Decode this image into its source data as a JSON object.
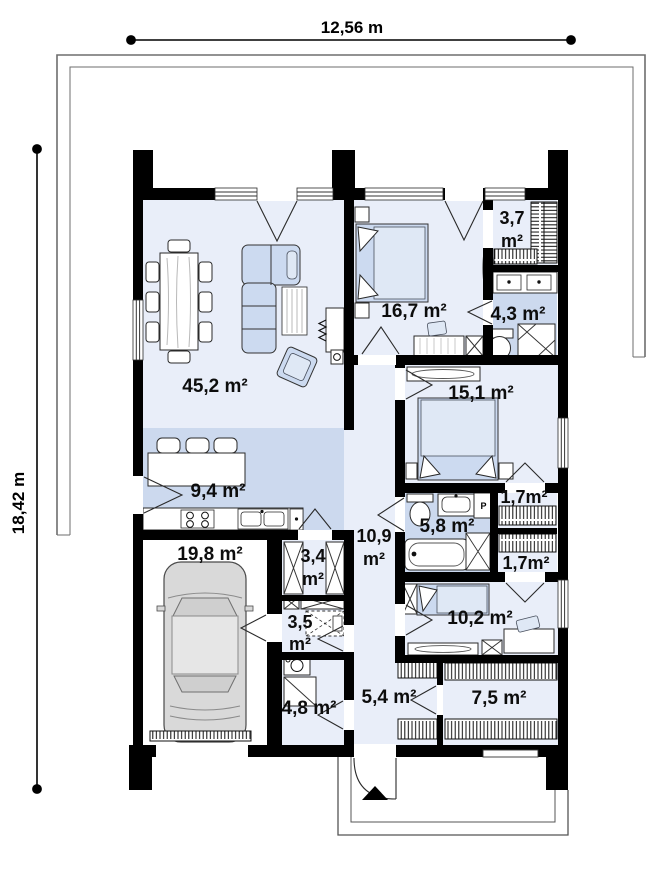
{
  "plan": {
    "dimension_width": "12,56 m",
    "dimension_height": "18,42 m",
    "rooms": [
      {
        "name": "living-dining-room",
        "area": "45,2 m²"
      },
      {
        "name": "kitchen",
        "area": "9,4 m²"
      },
      {
        "name": "bedroom-master",
        "area": "16,7 m²"
      },
      {
        "name": "wardrobe-master",
        "area_value": "3,7",
        "area_unit": "m²"
      },
      {
        "name": "bathroom-ensuite",
        "area": "4,3 m²"
      },
      {
        "name": "bedroom-2",
        "area": "15,1 m²"
      },
      {
        "name": "wardrobe-a",
        "area": "1,7m²"
      },
      {
        "name": "bathroom-main",
        "area": "5,8 m²"
      },
      {
        "name": "hallway",
        "area_value": "10,9",
        "area_unit": "m²"
      },
      {
        "name": "wardrobe-b",
        "area": "1,7m²"
      },
      {
        "name": "pantry",
        "area_value": "3,4",
        "area_unit": "m²"
      },
      {
        "name": "garage",
        "area": "19,8 m²"
      },
      {
        "name": "utility",
        "area_value": "3,5",
        "area_unit": "m²"
      },
      {
        "name": "bedroom-3",
        "area": "10,2 m²"
      },
      {
        "name": "boiler-room",
        "area": "4,8 m²"
      },
      {
        "name": "corridor",
        "area": "5,4 m²"
      },
      {
        "name": "wardrobe-hall",
        "area": "7,5 m²"
      }
    ],
    "appliance_labels": {
      "washer": "P"
    },
    "colors": {
      "wall": "#000000",
      "room_light": "#e9eef9",
      "room_medium": "#ccd9ee",
      "furniture_fill": "#ccdaf0",
      "outline_gray": "#6e6e6e"
    }
  }
}
